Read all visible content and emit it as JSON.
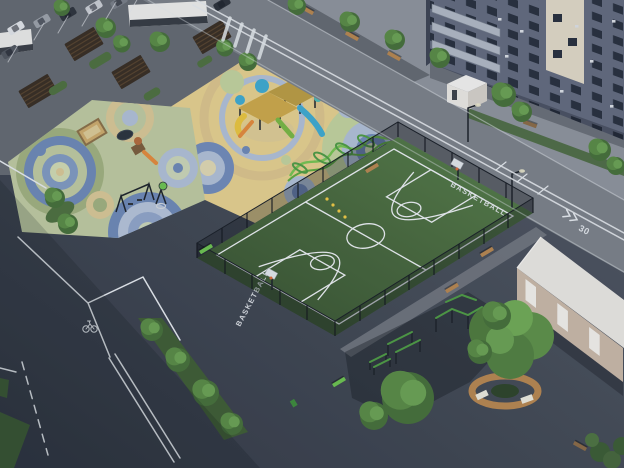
{
  "scene": {
    "type": "aerial-3d-render",
    "description": "Evening aerial view of a residential courtyard: colorful circle-pattern playgrounds, fenced basketball court, street workout zone, pergola plaza with parking, apartment block and round tree bench",
    "labels": {
      "court_text_ne": "BASKETBALL",
      "court_text_sw": "BASKETBALL",
      "road_speed_marking": "30"
    },
    "icons": {
      "bike_lane": "bicycle-road-marking",
      "speed_chevrons": "double-chevron-road-marking"
    },
    "regions": [
      "parking-lot",
      "retail-pavilion",
      "pergola-plaza",
      "toddler-playground",
      "main-playground",
      "basketball-court",
      "street-workout-area",
      "apartment-building",
      "community-building",
      "round-tree-bench",
      "roads"
    ],
    "colors": {
      "asphalt_dark": "#394049",
      "road": "#7b8086",
      "sidewalk": "#8d9299",
      "plaza": "#64696f",
      "rubber_yellow": "#e2cd8c",
      "rubber_sage": "#bcc79d",
      "circle_blue": "#6d87b3",
      "circle_pale_blue": "#aebdd2",
      "circle_tan": "#d5c493",
      "court_surface": "#4e545c",
      "court_green": "#74946a",
      "court_line": "#e8ebee",
      "turf_green": "#49683e",
      "fence_dark": "#161a1f",
      "equipment_green": "#74c150",
      "equipment_blue": "#3fa8cc",
      "equipment_yellow": "#e4bd3e",
      "equipment_orange": "#e0883a",
      "tree_green": "#598a44",
      "bench_wood": "#b5854e",
      "lime_bench": "#6cc04e",
      "facade": "#626a7c",
      "facade_windows": "#29303d",
      "facade_cream": "#ddd5c2",
      "entrance_white": "#e7e5df",
      "beige_wall": "#c7b6a4",
      "beige_roof": "#e6e4de",
      "store_white": "#e9e9e6",
      "marking_white": "#e2e6e9"
    }
  }
}
